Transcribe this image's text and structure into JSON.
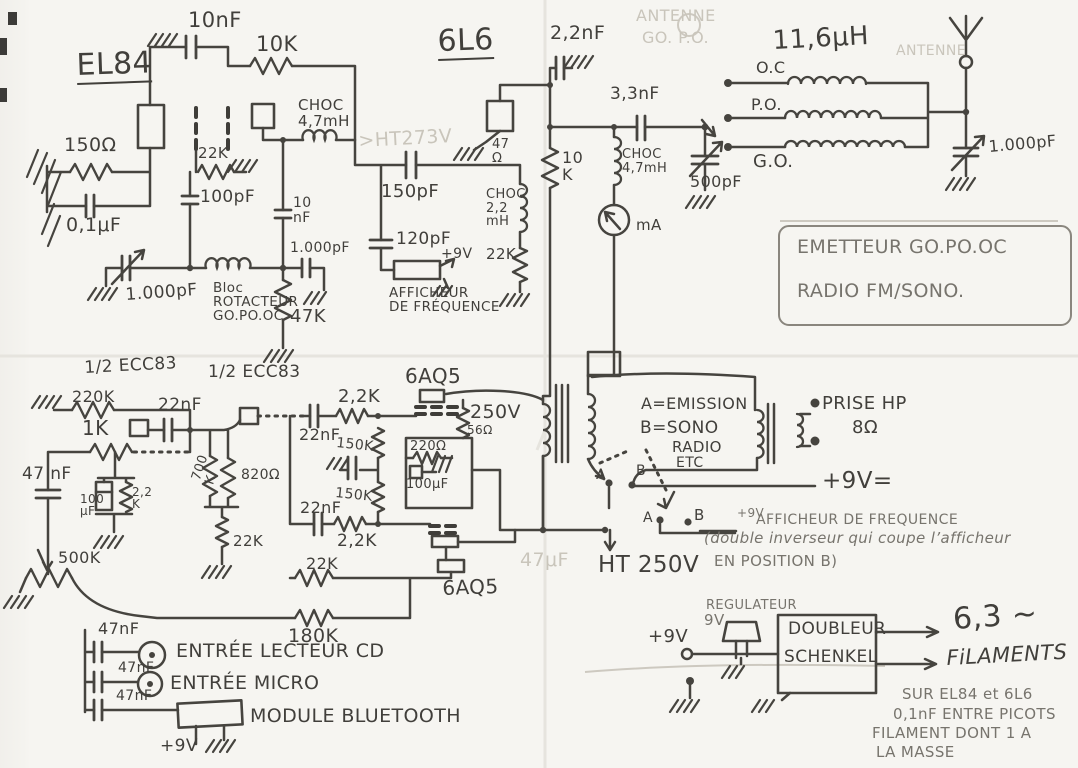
{
  "labels": {
    "el84": {
      "title": "EL84",
      "c_10nf": "10nF",
      "r_10k": "10K",
      "choke": "CHOC\n4,7mH",
      "r_150ohm": "150Ω",
      "r_22k": "22K",
      "c_01uf": "0,1μF",
      "c_100pf": "100pF",
      "c_10nf2": "10\nnF",
      "c_1000pf_fixed": "1.000pF",
      "c_1000pf_var": "1.000pF",
      "bloc": "Bloc\nROTACTEUR\nGO.PO.OC",
      "r_47k": "47K"
    },
    "pa6l6": {
      "title": "6L6",
      "ht_ghost": ">HT273V",
      "c_150pf": "150pF",
      "c_120pf": "120pF",
      "plus9v": "+9V",
      "afficheur": "AFFICHEUR\nDE FRÉQUENCE",
      "r_47ohm": "47\nΩ",
      "choke": "CHOC\n2,2\nmH",
      "r_22k": "22K",
      "c_22nf": "2,2nF",
      "r_10k": "10\nK"
    },
    "antenna": {
      "c_33nf": "3,3nF",
      "choke": "CHOC\n4,7mH",
      "meter": "mA",
      "c_500pf": "500pF",
      "coil": "11,6μH",
      "oc": "O.C",
      "po": "P.O.",
      "go": "G.O.",
      "c_1000pf_var": "1.000pF",
      "ghost_antenne_top": "ANTENNE",
      "ghost_gopo": "GO. P.O.",
      "ghost_antenne_right": "ANTENNE"
    },
    "titlebox": {
      "line1": "EMETTEUR GO.PO.OC",
      "line2": "RADIO FM/SONO."
    },
    "preamp": {
      "tube1": "1/2 ECC83",
      "tube2": "1/2 ECC83",
      "r_220k": "220K",
      "r_1k": "1K",
      "c_22nf1": "22nF",
      "c_100uf": "100\nμF",
      "r_22k_cath": "2,2\nK",
      "c_47nf": "47 nF",
      "pot_500k": "500K",
      "r_700k": "700\nK",
      "r_820ohm": "820Ω",
      "r_22k1": "22K",
      "c_22nf2": "22nF",
      "r_22k_coup1": "2,2K",
      "r_150k1": "150K",
      "r_150k2": "150K",
      "c_22nf3": "22nF",
      "r_22k_coup2": "2,2K",
      "r_22k2": "22K",
      "r_180k": "180K"
    },
    "output": {
      "tube1": "6AQ5",
      "tube2": "6AQ5",
      "v250": "250V",
      "r_56ohm": "56Ω",
      "r_220ohm": "220Ω",
      "c_100uf": "100μF",
      "ht250": "HT 250V",
      "c_47uf_ghost": "47μF"
    },
    "switching": {
      "a_emission": "A=EMISSION",
      "b_sono": "B=SONO",
      "radio": "RADIO",
      "etc": "ETC",
      "a1": "A",
      "b1": "B",
      "a2": "A",
      "b2": "B",
      "prise_hp": "PRISE HP",
      "ohm8": "8Ω",
      "plus9v_eq": "+9V=",
      "note_9v": "+9V",
      "note_afficheur": "AFFICHEUR DE FREQUENCE",
      "note_double": "(double inverseur qui coupe l’afficheur",
      "note_position": "EN POSITION B)"
    },
    "inputs": {
      "c_47nf1": "47nF",
      "in_cd": "ENTRÉE LECTEUR CD",
      "c_47nf2": "47nF",
      "in_micro": "ENTRÉE MICRO",
      "c_47nf3": "47nF",
      "module_bt": "MODULE BLUETOOTH",
      "plus9v": "+9V"
    },
    "power": {
      "plus9v": "+9V",
      "regulateur": "REGULATEUR",
      "v9": "9V",
      "doubleur": "DOUBLEUR",
      "schenkel": "SCHENKEL",
      "v63": "6,3 ∼",
      "filaments": "FiLAMENTS",
      "note1": "SUR EL84 et 6L6",
      "note2": "0,1nF ENTRE PICOTS",
      "note3": "FILAMENT DONT 1 A",
      "note4": "LA MASSE"
    }
  }
}
